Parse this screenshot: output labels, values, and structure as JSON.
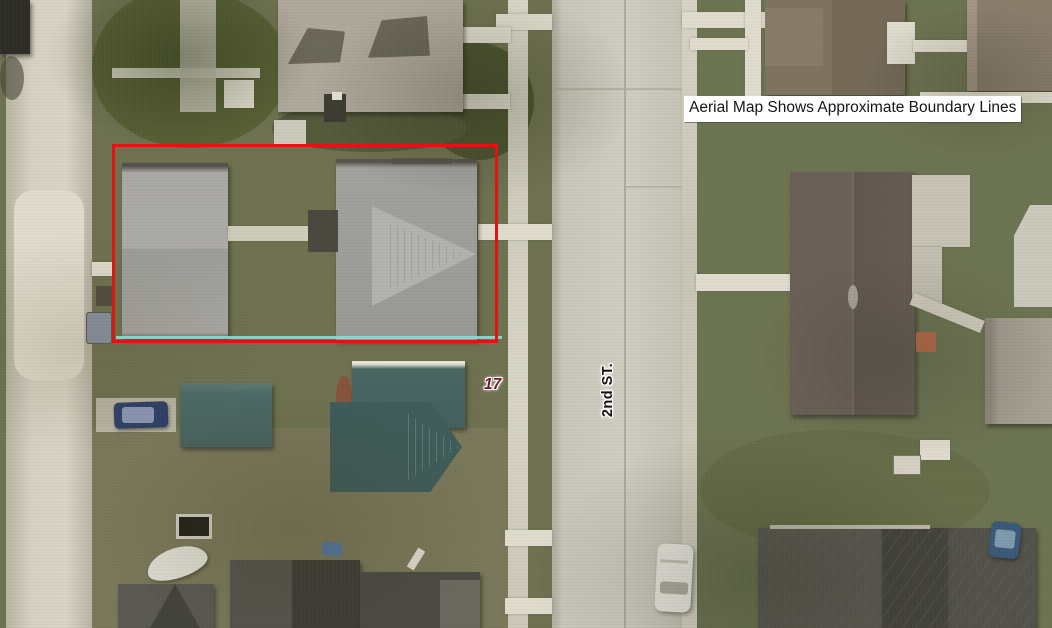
{
  "map": {
    "banner_label": "Aerial Map Shows Approximate Boundary Lines",
    "street_label": "2nd ST.",
    "lot_number": "17",
    "colors": {
      "boundary_red": "#de1510",
      "boundary_cyan": "#8ed8d4",
      "lot_number_color": "#6e1c2a",
      "street_label_color": "#141414",
      "banner_background": "#ffffff",
      "banner_text": "#151515",
      "grass_base": "#6e7250",
      "road_pavement": "#c7c4b8",
      "sidewalk": "#dad6c8",
      "subject_roof_gray": "#9d9d99",
      "teal_roof": "#496663",
      "brown_roof": "#7e7261",
      "dark_roof": "#57564f"
    },
    "features": {
      "boundary_box": "red-rectangle-property-boundary",
      "vehicles": [
        "white-van-on-street",
        "blue-car-driveway",
        "blue-car-bottom-right"
      ],
      "street_orientation": "vertical"
    }
  }
}
